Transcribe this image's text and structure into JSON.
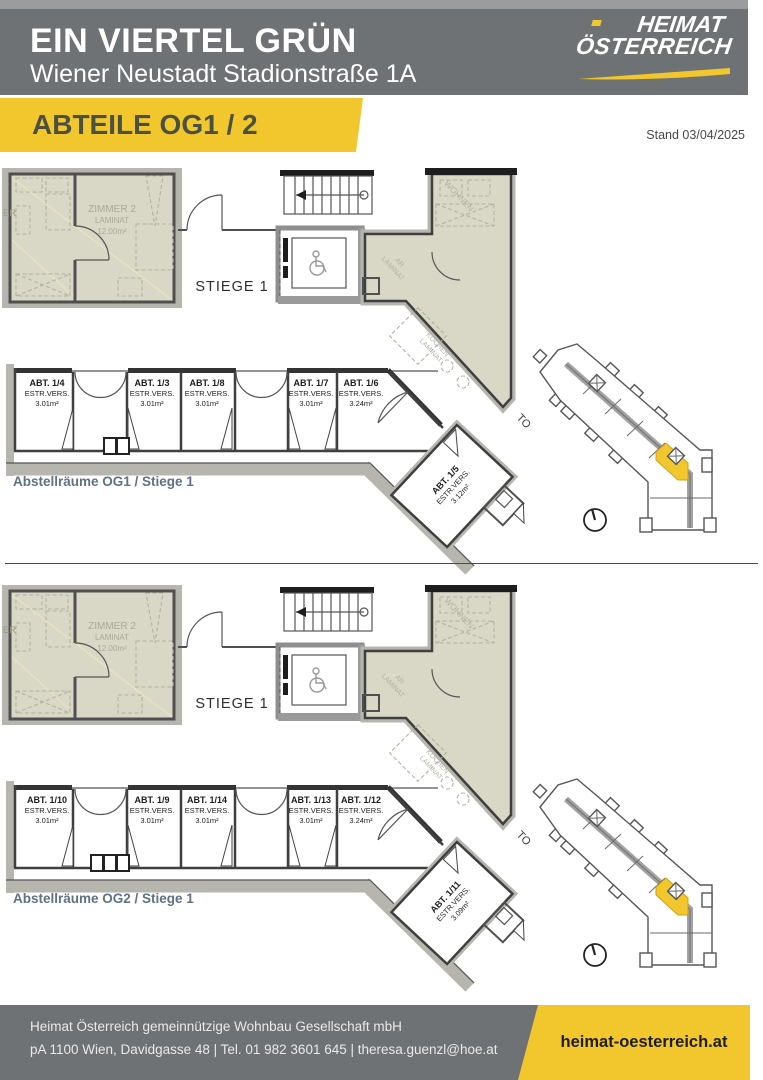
{
  "header": {
    "title": "EIN VIERTEL GRÜN",
    "subtitle": "Wiener Neustadt Stadionstraße 1A",
    "logo_top": "HEIMAT",
    "logo_bottom": "ÖSTERREICH"
  },
  "banner": {
    "title": "ABTEILE OG1 / 2",
    "date": "Stand 03/04/2025"
  },
  "colors": {
    "gray": "#6f7274",
    "yellow": "#f2c72e",
    "beige": "#d9d8c6",
    "caption": "#5f7183"
  },
  "plans": [
    {
      "caption": "Abstellräume OG1 / Stiege 1",
      "stiege_label": "STIEGE 1",
      "room": {
        "partial": "ER",
        "name": "ZIMMER 2",
        "floor": "LAMINAT",
        "area": "12.00m²"
      },
      "side_labels": {
        "wohnen": "WOHNEN",
        "ar1": "AR",
        "ar2": "LAMINAT",
        "kochen1": "KOCHEN",
        "kochen2": "LAMINAT"
      },
      "compartments": [
        {
          "id": "ABT. 1/4",
          "screed": "ESTR.VERS.",
          "area": "3.01m²"
        },
        {
          "id": "ABT. 1/3",
          "screed": "ESTR.VERS.",
          "area": "3.01m²"
        },
        {
          "id": "ABT. 1/8",
          "screed": "ESTR.VERS.",
          "area": "3.01m²"
        },
        {
          "id": "ABT. 1/7",
          "screed": "ESTR.VERS.",
          "area": "3.01m²"
        },
        {
          "id": "ABT. 1/6",
          "screed": "ESTR.VERS.",
          "area": "3.24m²"
        }
      ],
      "diagonal": {
        "id": "ABT. 1/5",
        "screed": "ESTR.VERS.",
        "area": "3.12m²"
      },
      "partial_top": "TO"
    },
    {
      "caption": "Abstellräume OG2 / Stiege 1",
      "stiege_label": "STIEGE 1",
      "room": {
        "partial": "ER",
        "name": "ZIMMER 2",
        "floor": "LAMINAT",
        "area": "12.00m²"
      },
      "side_labels": {
        "wohnen": "WOHNEN",
        "ar1": "AR",
        "ar2": "LAMINAT",
        "kochen1": "KOCHEN",
        "kochen2": "LAMINAT"
      },
      "compartments": [
        {
          "id": "ABT. 1/10",
          "screed": "ESTR.VERS.",
          "area": "3.01m²"
        },
        {
          "id": "ABT. 1/9",
          "screed": "ESTR.VERS.",
          "area": "3.01m²"
        },
        {
          "id": "ABT. 1/14",
          "screed": "ESTR.VERS.",
          "area": "3.01m²"
        },
        {
          "id": "ABT. 1/13",
          "screed": "ESTR.VERS.",
          "area": "3.01m²"
        },
        {
          "id": "ABT. 1/12",
          "screed": "ESTR.VERS.",
          "area": "3.24m²"
        }
      ],
      "diagonal": {
        "id": "ABT. 1/11",
        "screed": "ESTR.VERS.",
        "area": "3.09m²"
      },
      "partial_top": "TO"
    }
  ],
  "footer": {
    "line1": "Heimat Österreich gemeinnützige Wohnbau Gesellschaft mbH",
    "line2": "pA 1100 Wien, Davidgasse 48   |   Tel. 01 982 3601 645   |   theresa.guenzl@hoe.at",
    "website": "heimat-oesterreich.at"
  }
}
